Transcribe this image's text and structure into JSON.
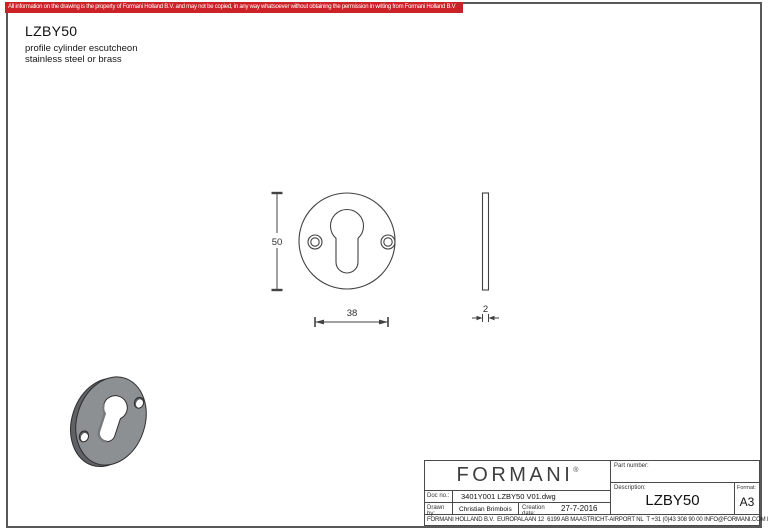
{
  "banner": {
    "text": "All information on the drawing is the property of Formani Holland B.V. and may not be copied, in any way whatsoever without obtaining the permission in writing from Formani Holland B.V",
    "bg_color": "#cc2127",
    "text_color": "#ffffff"
  },
  "header": {
    "title": "LZBY50",
    "subtitle_line1": "profile cylinder escutcheon",
    "subtitle_line2": "stainless steel or brass"
  },
  "drawing": {
    "height_mm": "50",
    "width_mm": "38",
    "thickness_mm": "2",
    "line_color": "#424242",
    "render_face_color": "#8d9093",
    "render_rim_color": "#5e6165"
  },
  "title_block": {
    "logo": "FORMANI",
    "logo_reg": "®",
    "doc_no_label": "Doc no.:",
    "doc_no_value": "3401Y001 LZBY50 V01.dwg",
    "drawn_by_label": "Drawn by:",
    "drawn_by_value": "Christian Brimbois",
    "creation_date_label": "Creation date:",
    "creation_date_value": "27-7-2016",
    "part_number_label": "Part number:",
    "description_label": "Description:",
    "description_value": "LZBY50",
    "format_label": "Format:",
    "format_value": "A3",
    "address": "FORMANI HOLLAND B.V.  EUROPALAAN 12  6199 AB MAASTRICHT-AIRPORT NL  T +31 (0)43 308 90 00 INFO@FORMANI.COM FORMANI.COM"
  }
}
